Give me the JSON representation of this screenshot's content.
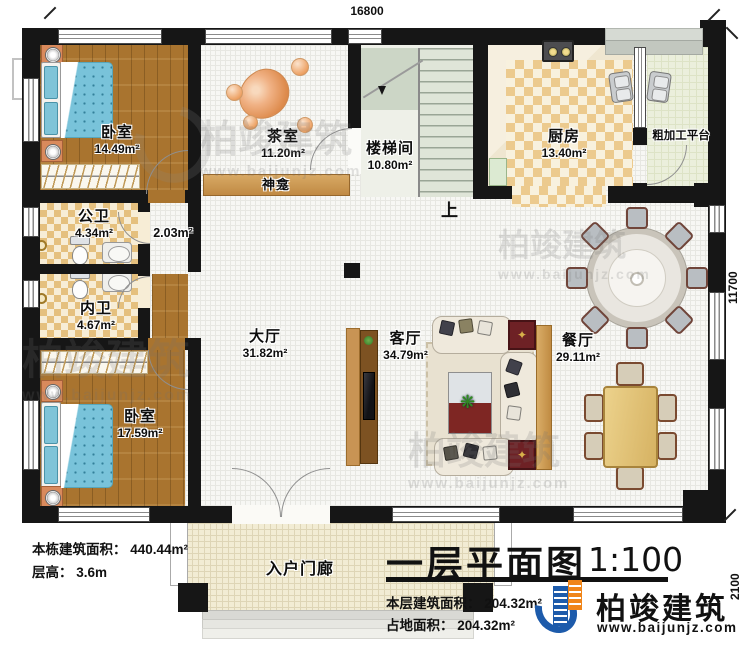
{
  "dimensions": {
    "top": "16800",
    "right": "11700",
    "porch_depth": "2100"
  },
  "rooms": {
    "bedroom1": {
      "name": "卧室",
      "area": "14.49m²"
    },
    "tea_room": {
      "name": "茶室",
      "area": "11.20m²"
    },
    "stairwell": {
      "name": "楼梯间",
      "area": "10.80m²"
    },
    "kitchen": {
      "name": "厨房",
      "area": "13.40m²"
    },
    "platform": {
      "name": "粗加工平台"
    },
    "shrine": {
      "name": "神龛"
    },
    "public_bath": {
      "name": "公卫",
      "area": "4.34m²"
    },
    "corridor": {
      "area": "2.03m²"
    },
    "private_bath": {
      "name": "内卫",
      "area": "4.67m²"
    },
    "hall": {
      "name": "大厅",
      "area": "31.82m²"
    },
    "living": {
      "name": "客厅",
      "area": "34.79m²"
    },
    "dining": {
      "name": "餐厅",
      "area": "29.11m²"
    },
    "bedroom2": {
      "name": "卧室",
      "area": "17.59m²"
    },
    "porch": {
      "name": "入户门廊"
    }
  },
  "annotations": {
    "stairs_up": "上"
  },
  "building_info": {
    "total_area": "本栋建筑面积： 440.44m²",
    "floor_height": "层高： 3.6m"
  },
  "title_block": {
    "title": "一层平面图",
    "scale": "1:100",
    "floor_area": "本层建筑面积： 204.32m²",
    "footprint": "占地面积： 204.32m²"
  },
  "logo": {
    "name": "柏竣建筑",
    "website": "www.baijunjz.com"
  },
  "watermark": {
    "name": "柏竣建筑",
    "website": "www.baijunjz.com"
  },
  "colors": {
    "wall": "#161616",
    "wood": "#a9742f",
    "checker": "#e5c07e",
    "shrine_bar": "#c89a5a",
    "logo_blue": "#1d5bab",
    "logo_orange": "#f08519"
  }
}
